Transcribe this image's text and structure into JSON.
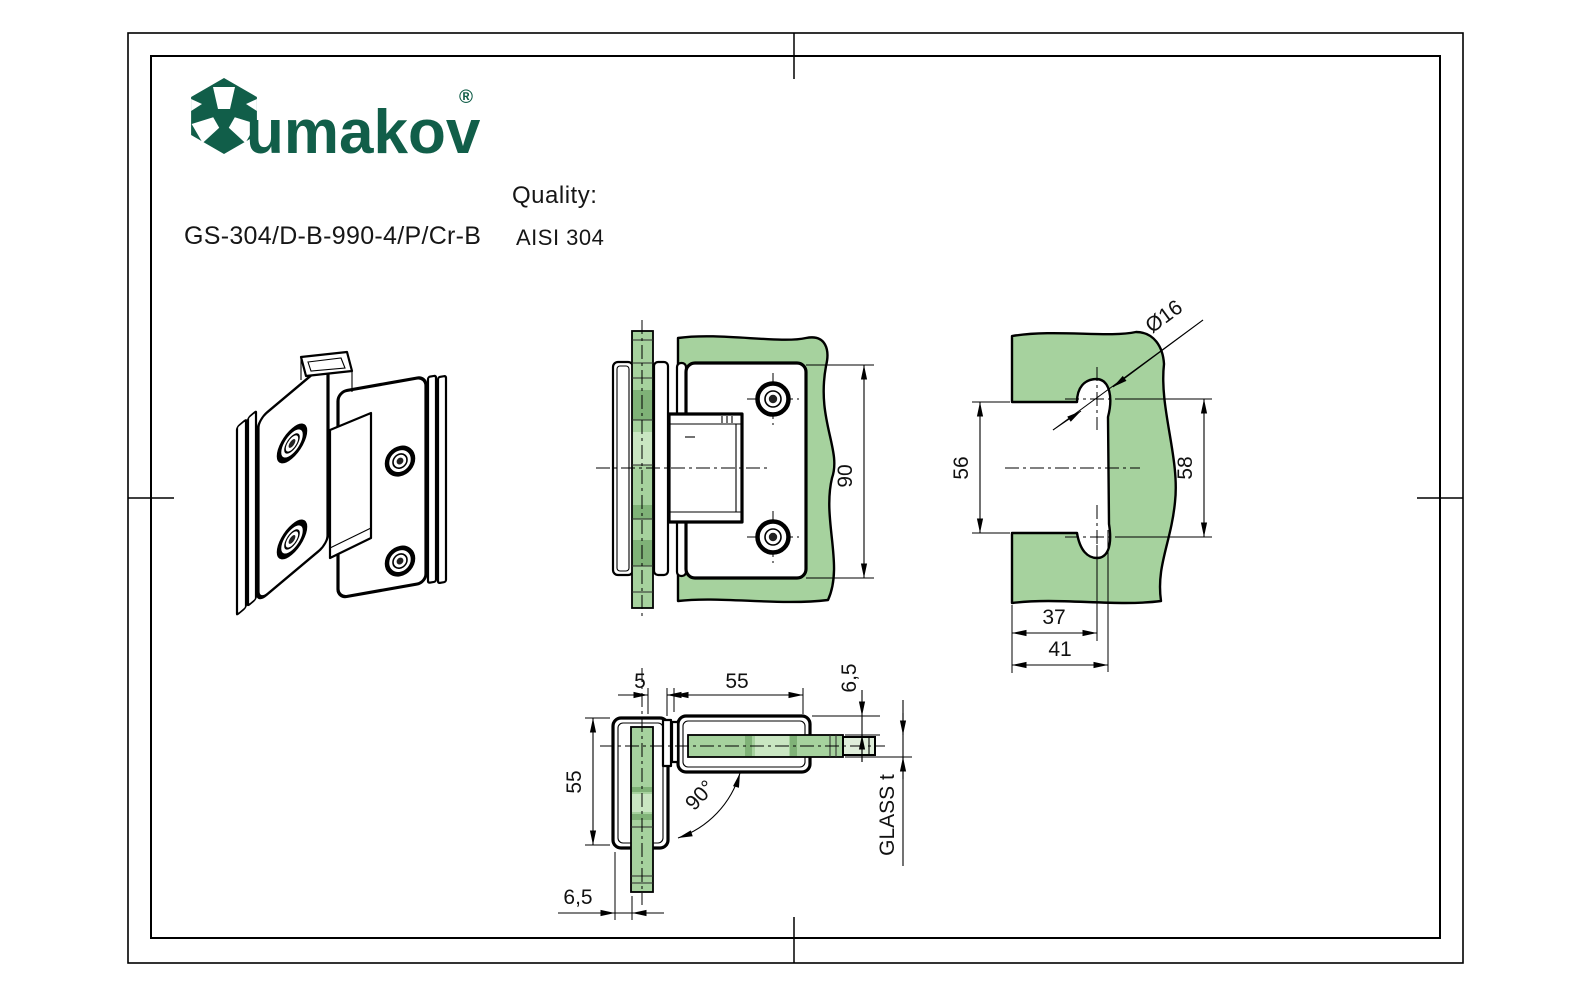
{
  "brand": {
    "name": "umakov",
    "registered": "®"
  },
  "header": {
    "product_code": "GS-304/D-B-990-4/P/Cr-B",
    "quality_label": "Quality:",
    "quality_value": "AISI 304"
  },
  "colors": {
    "brand_green": "#115e49",
    "glass_green": "#a6d29e",
    "glass_green_dark": "#7fb277",
    "glass_green_light": "#c9e6c2",
    "line_black": "#000000"
  },
  "views": {
    "front": {
      "dim_height": "90"
    },
    "glass_cutout": {
      "dim_diameter": "Ø16",
      "dim_cutout_height": "56",
      "dim_hole_centers": "58",
      "dim_hole_center_offset": "37",
      "dim_cutout_depth": "41"
    },
    "top": {
      "dim_gap": "5",
      "dim_plate_length": "55",
      "dim_plate_offset_top": "6,5",
      "dim_opening_angle": "90°",
      "dim_glass_thickness": "GLASS t",
      "dim_plate_length_left": "55",
      "dim_plate_offset_bottom": "6,5"
    }
  }
}
